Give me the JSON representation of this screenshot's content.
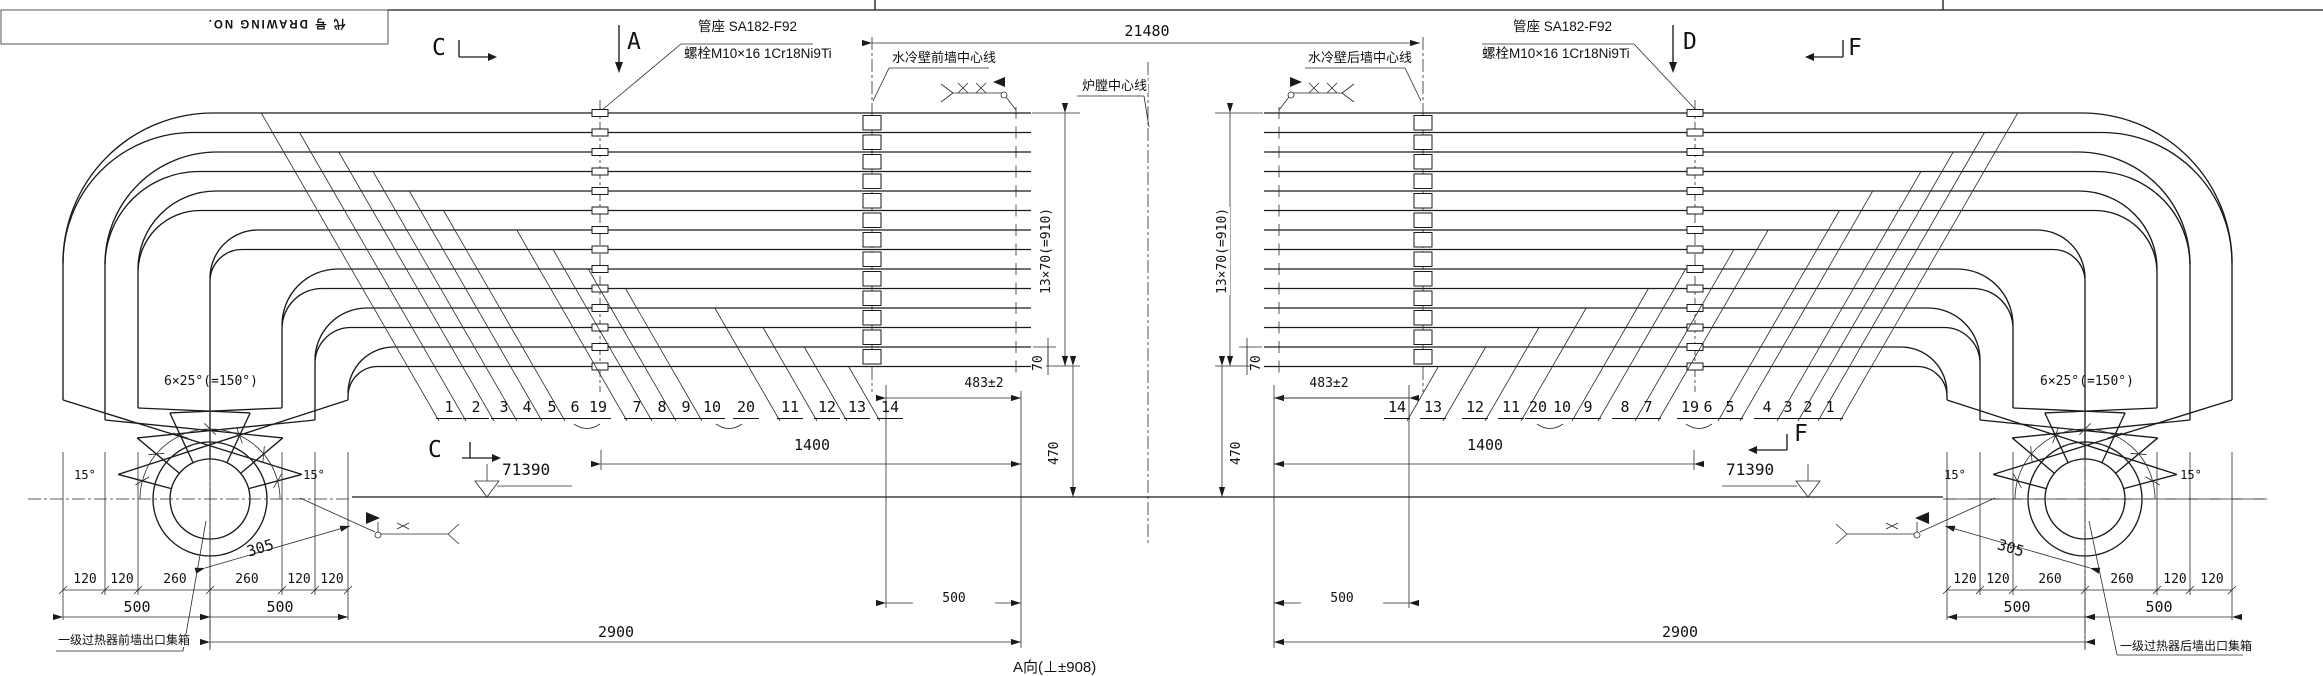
{
  "sheet": {
    "title_block": "代 号 DRAWING NO."
  },
  "view_markers": {
    "a": "A",
    "c": "C",
    "d": "D",
    "f": "F",
    "bottom_note": "A向(⊥±908)"
  },
  "callouts": {
    "pipe_seat_spec": "管座 SA182-F92",
    "bolt_spec": "螺栓M10×16 1Cr18Ni9Ti",
    "front_wall_centerline": "水冷壁前墙中心线",
    "rear_wall_centerline": "水冷壁后墙中心线",
    "furnace_centerline": "炉膛中心线",
    "front_outlet_header": "一级过热器前墙出口集箱",
    "rear_outlet_header": "一级过热器后墙出口集箱"
  },
  "dimensions": {
    "overall_span": "21480",
    "row_pitch": "13×70(=910)",
    "row_gap": "70",
    "end_offset": "483±2",
    "seat_span": "1400",
    "drop": "470",
    "elevation": "71390",
    "half_span": "500",
    "header_span": "2900",
    "seg_120": "120",
    "seg_260": "260",
    "radius": "305",
    "angle_end": "15°",
    "angle_fan": "6×25°(=150°)"
  },
  "tube_numbers": {
    "left": [
      "1",
      "2",
      "3",
      "4",
      "5",
      "6",
      "19",
      "7",
      "8",
      "9",
      "10",
      "20",
      "11",
      "12",
      "13",
      "14"
    ],
    "right": [
      "14",
      "13",
      "12",
      "11",
      "20",
      "10",
      "9",
      "8",
      "7",
      "19",
      "6",
      "5",
      "4",
      "3",
      "2",
      "1"
    ]
  }
}
